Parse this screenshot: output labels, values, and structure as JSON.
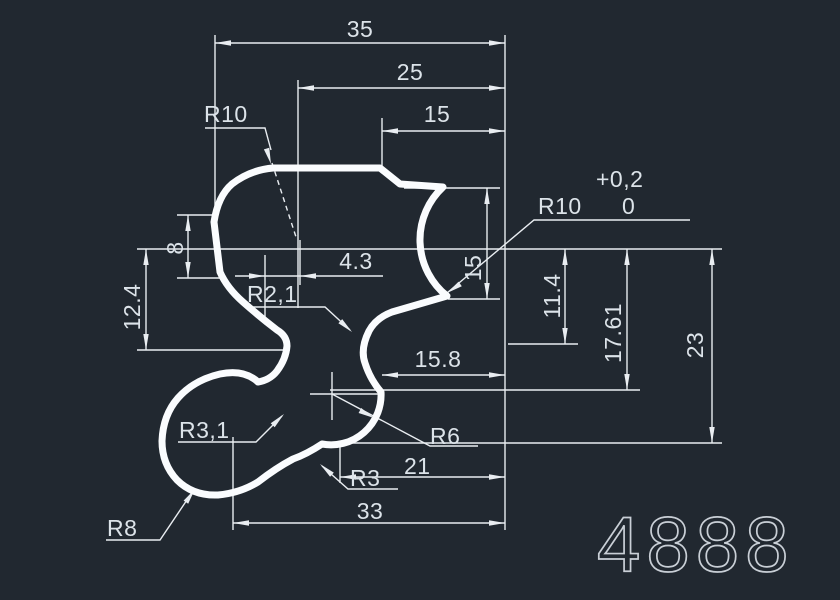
{
  "colors": {
    "background": "#212830",
    "lines": "#e9edf1",
    "dim_text": "#dce3e9",
    "big_number": "#c9cfd6"
  },
  "drawing_number": "4888",
  "dims": {
    "top_35": "35",
    "top_25": "25",
    "top_15": "15",
    "left_8": "8",
    "left_12_4": "12.4",
    "mid_4_3": "4.3",
    "radius_r10_left": "R10",
    "radius_r2_1": "R2,1",
    "radius_r10_right": "R10",
    "tol_upper": "+0,2",
    "tol_lower": "0",
    "vert_15": "15",
    "vert_11_4": "11.4",
    "vert_17_61": "17.61",
    "vert_23": "23",
    "mid_15_8": "15.8",
    "radius_r6": "R6",
    "radius_r3": "R3",
    "low_21": "21",
    "low_33": "33",
    "radius_r3_1": "R3,1",
    "radius_r8": "R8"
  }
}
